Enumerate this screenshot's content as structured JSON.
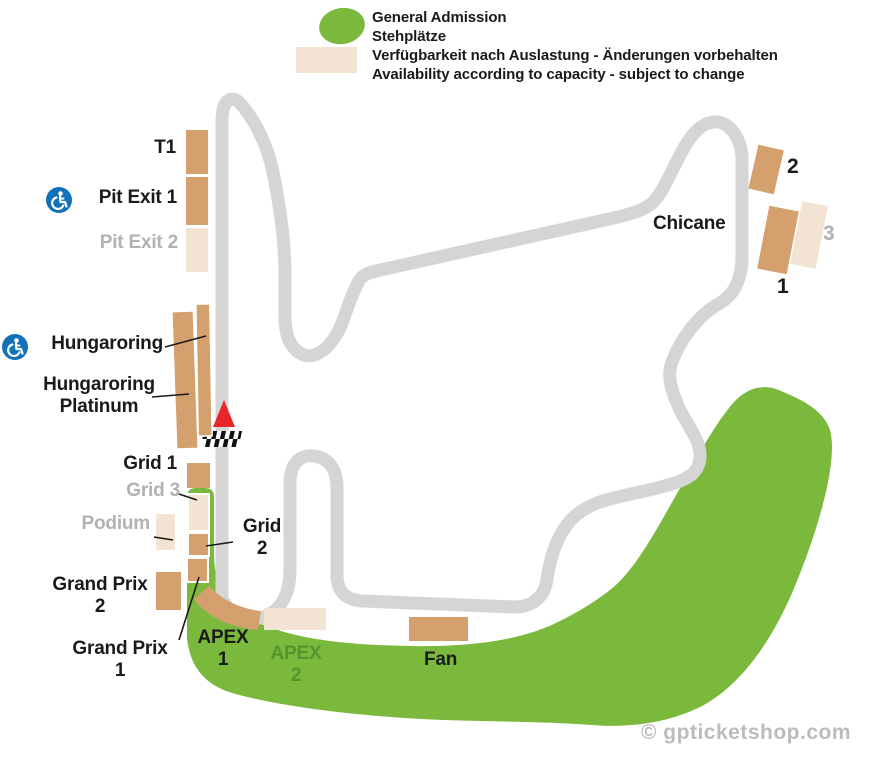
{
  "legend": {
    "general_admission": "General Admission\nStehplätze",
    "availability": "Verfügbarkeit nach Auslastung - Änderungen vorbehalten\nAvailability according to capacity - subject to change"
  },
  "labels": {
    "t1": "T1",
    "pit_exit_1": "Pit Exit 1",
    "pit_exit_2": "Pit Exit 2",
    "hungaroring": "Hungaroring",
    "hungaroring_platinum": "Hungaroring\nPlatinum",
    "grid_1": "Grid 1",
    "grid_3": "Grid 3",
    "podium": "Podium",
    "grand_prix_2": "Grand Prix\n2",
    "grand_prix_1": "Grand Prix\n1",
    "grid_2": "Grid\n2",
    "apex_1": "APEX\n1",
    "apex_2": "APEX\n2",
    "fan": "Fan",
    "chicane": "Chicane",
    "stand_2": "2",
    "stand_3": "3",
    "stand_1": "1"
  },
  "watermark": "© gpticketshop.com",
  "colors": {
    "general_admission_green": "#7bb93d",
    "stand_available_tan": "#d3a06e",
    "stand_limited_beige": "#f3e3d2",
    "track_gray": "#d5d5d5",
    "accessible_blue": "#1072b8",
    "start_marker_red": "#e8252a",
    "muted_label_gray": "#b2b2b2",
    "apex2_label_green": "#55942c",
    "watermark_gray": "#bcbcbc"
  }
}
